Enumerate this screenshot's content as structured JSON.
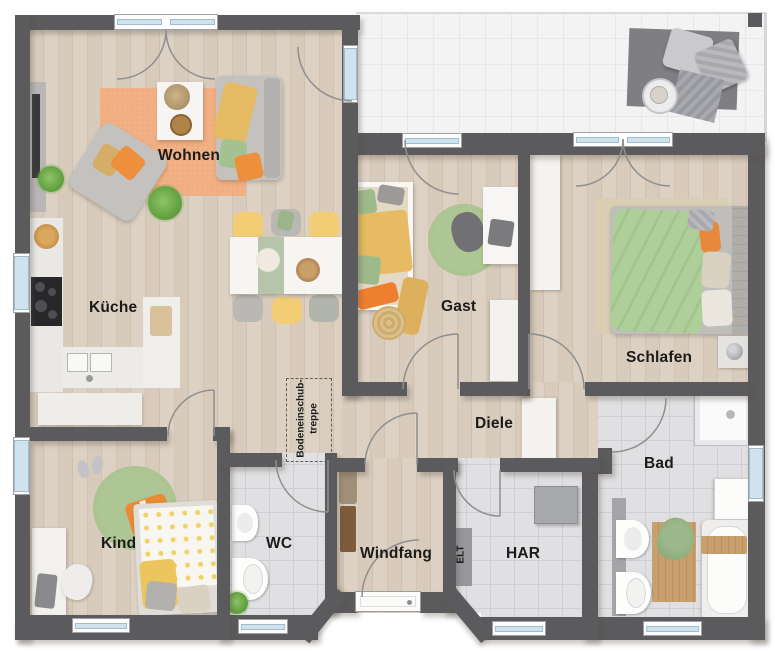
{
  "plan": {
    "title": "Bungalow floor plan (top-down render)",
    "rooms": {
      "wohnen": {
        "label": "Wohnen"
      },
      "kueche": {
        "label": "Küche"
      },
      "gast": {
        "label": "Gast"
      },
      "schlafen": {
        "label": "Schlafen"
      },
      "diele": {
        "label": "Diele"
      },
      "bad": {
        "label": "Bad"
      },
      "kind": {
        "label": "Kind"
      },
      "wc": {
        "label": "WC"
      },
      "windfang": {
        "label": "Windfang"
      },
      "elt": {
        "label": "ELT"
      },
      "har": {
        "label": "HAR"
      }
    },
    "annotations": {
      "attic_stairs_line1": "Bodeneinschub-",
      "attic_stairs_line2": "treppe"
    },
    "colors": {
      "wall": "#5b5a5c",
      "wood_floor": "#d6c9ba",
      "tile_floor": "#e0e0e2",
      "terrace_floor": "#f3f3f4",
      "window_glass": "#cfe3ee",
      "accent_orange": "#ee8f3c",
      "accent_yellow": "#e6bb64",
      "accent_green": "#a5c392",
      "rug_orange": "#f1b185"
    }
  }
}
